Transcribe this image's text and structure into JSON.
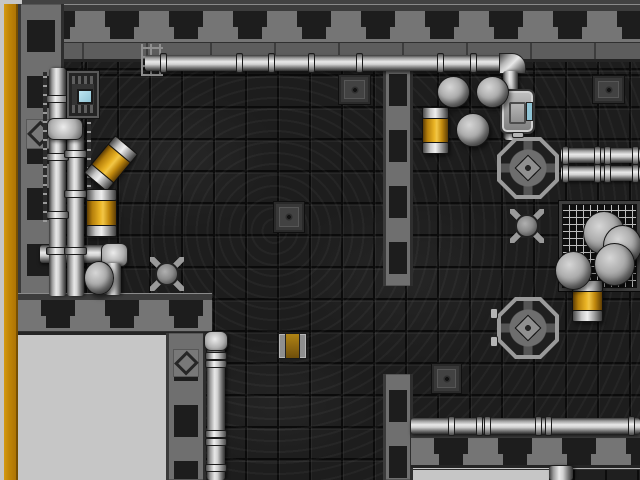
{
  "scene": {
    "width": 640,
    "height": 480,
    "palette": {
      "void": "#c6c6c6",
      "gold": "#bf8406",
      "wall_light": "#757575",
      "wall_dark": "#1d1d1d",
      "floor": "#1d1d1d",
      "pipe": "#d2d2d2",
      "barrel_orange": "#eab425",
      "screen_blue": "#8fc3d4",
      "spike_red": "#cf2418"
    },
    "objects": [
      {
        "name": "top-border-strip",
        "type": "top-strip",
        "x": 22,
        "y": 0,
        "w": 618,
        "h": 6,
        "interactable": false
      },
      {
        "name": "gold-border",
        "type": "gold-stripe",
        "x": 4,
        "y": 4,
        "w": 14,
        "h": 476,
        "interactable": false
      },
      {
        "name": "floor-main",
        "type": "floor",
        "x": 60,
        "y": 58,
        "w": 580,
        "h": 422,
        "interactable": false
      },
      {
        "name": "void-bottom-left",
        "type": "void",
        "x": 18,
        "y": 333,
        "w": 150,
        "h": 147,
        "interactable": false
      },
      {
        "name": "void-bottom-right",
        "type": "void",
        "x": 413,
        "y": 466,
        "w": 136,
        "h": 14,
        "interactable": false
      },
      {
        "name": "ledge-bottom-right",
        "type": "ledge",
        "x": 573,
        "y": 466,
        "w": 67,
        "h": 14,
        "interactable": false
      },
      {
        "name": "wall-top",
        "type": "wall-h",
        "x": 18,
        "y": 4,
        "w": 622,
        "h": 58,
        "interactable": false
      },
      {
        "name": "wall-left",
        "type": "wall-v",
        "x": 18,
        "y": 4,
        "w": 46,
        "h": 298,
        "interactable": false
      },
      {
        "name": "wall-room-a-bottom",
        "type": "wall-h",
        "x": 18,
        "y": 293,
        "w": 194,
        "h": 42,
        "interactable": false
      },
      {
        "name": "wall-void-column",
        "type": "wall-v",
        "x": 166,
        "y": 333,
        "w": 40,
        "h": 147,
        "interactable": false
      },
      {
        "name": "wall-divider-upper",
        "type": "wall-v",
        "x": 383,
        "y": 58,
        "w": 30,
        "h": 228,
        "interactable": false
      },
      {
        "name": "wall-divider-lower",
        "type": "wall-v",
        "x": 383,
        "y": 374,
        "w": 30,
        "h": 106,
        "interactable": false
      },
      {
        "name": "wall-room-b-bottom",
        "type": "wall-h",
        "x": 411,
        "y": 431,
        "w": 229,
        "h": 37,
        "interactable": false
      },
      {
        "name": "diamond-ornament",
        "type": "diamond",
        "x": 26,
        "y": 119,
        "w": 28,
        "h": 30,
        "interactable": false
      },
      {
        "name": "diamond-ornament",
        "type": "diamond",
        "x": 173,
        "y": 349,
        "w": 26,
        "h": 28,
        "interactable": false
      },
      {
        "name": "mesh-floor",
        "type": "mesh",
        "x": 559,
        "y": 201,
        "w": 81,
        "h": 90,
        "interactable": false
      },
      {
        "name": "pipe-junction",
        "type": "pipe-h",
        "x": 40,
        "y": 245,
        "w": 70,
        "h": 18,
        "interactable": false
      },
      {
        "name": "pipe-elbow-junction",
        "type": "pipe-joint",
        "x": 101,
        "y": 243,
        "w": 27,
        "h": 24,
        "interactable": false
      },
      {
        "name": "pipe-junction-drop",
        "type": "pipe-v",
        "x": 105,
        "y": 263,
        "w": 16,
        "h": 32,
        "interactable": false
      },
      {
        "name": "pipe-left-outer",
        "type": "pipe-v",
        "x": 49,
        "y": 68,
        "w": 17,
        "h": 228,
        "interactable": false
      },
      {
        "name": "pipe-left-inner",
        "type": "pipe-v",
        "x": 67,
        "y": 126,
        "w": 17,
        "h": 170,
        "interactable": false
      },
      {
        "name": "pipe-elbow-left",
        "type": "pipe-joint",
        "x": 47,
        "y": 118,
        "w": 36,
        "h": 22,
        "interactable": false
      },
      {
        "name": "pipe-coupling",
        "type": "coupling-v",
        "x": 46,
        "y": 95,
        "w": 23,
        "h": 8,
        "interactable": false
      },
      {
        "name": "pipe-coupling",
        "type": "coupling-v",
        "x": 46,
        "y": 153,
        "w": 23,
        "h": 8,
        "interactable": false
      },
      {
        "name": "pipe-coupling",
        "type": "coupling-v",
        "x": 46,
        "y": 211,
        "w": 23,
        "h": 8,
        "interactable": false
      },
      {
        "name": "pipe-coupling",
        "type": "coupling-v",
        "x": 46,
        "y": 247,
        "w": 23,
        "h": 8,
        "interactable": false
      },
      {
        "name": "pipe-coupling",
        "type": "coupling-v",
        "x": 64,
        "y": 150,
        "w": 23,
        "h": 8,
        "interactable": false
      },
      {
        "name": "pipe-coupling",
        "type": "coupling-v",
        "x": 64,
        "y": 190,
        "w": 23,
        "h": 8,
        "interactable": false
      },
      {
        "name": "pipe-coupling",
        "type": "coupling-v",
        "x": 64,
        "y": 247,
        "w": 23,
        "h": 8,
        "interactable": false
      },
      {
        "name": "wall-rail",
        "type": "rail-v",
        "x": 43,
        "y": 72,
        "w": 4,
        "h": 150,
        "interactable": false
      },
      {
        "name": "wall-rail",
        "type": "rail-v",
        "x": 87,
        "y": 122,
        "w": 4,
        "h": 110,
        "interactable": false
      },
      {
        "name": "pipe-bracket",
        "type": "pipe-bracket",
        "x": 141,
        "y": 44,
        "w": 22,
        "h": 32,
        "interactable": false
      },
      {
        "name": "pipe-top",
        "type": "pipe-h",
        "x": 145,
        "y": 55,
        "w": 358,
        "h": 16,
        "interactable": false
      },
      {
        "name": "pipe-coupling",
        "type": "coupling-h",
        "x": 160,
        "y": 53,
        "w": 7,
        "h": 20,
        "interactable": false
      },
      {
        "name": "pipe-coupling",
        "type": "coupling-h",
        "x": 236,
        "y": 53,
        "w": 7,
        "h": 20,
        "interactable": false
      },
      {
        "name": "pipe-coupling",
        "type": "coupling-h",
        "x": 268,
        "y": 53,
        "w": 7,
        "h": 20,
        "interactable": false
      },
      {
        "name": "pipe-coupling",
        "type": "coupling-h",
        "x": 308,
        "y": 53,
        "w": 7,
        "h": 20,
        "interactable": false
      },
      {
        "name": "pipe-coupling",
        "type": "coupling-h",
        "x": 356,
        "y": 53,
        "w": 7,
        "h": 20,
        "interactable": false
      },
      {
        "name": "pipe-coupling",
        "type": "coupling-h",
        "x": 437,
        "y": 53,
        "w": 7,
        "h": 20,
        "interactable": false
      },
      {
        "name": "pipe-coupling",
        "type": "coupling-h",
        "x": 470,
        "y": 53,
        "w": 7,
        "h": 20,
        "interactable": false
      },
      {
        "name": "pipe-elbow-top",
        "type": "pipe-elbow",
        "x": 499,
        "y": 53,
        "w": 27,
        "h": 21,
        "interactable": false
      },
      {
        "name": "pipe-top-drop",
        "type": "pipe-v",
        "x": 503,
        "y": 71,
        "w": 15,
        "h": 20,
        "interactable": false
      },
      {
        "name": "pipe-corridor",
        "type": "pipe-v",
        "x": 207,
        "y": 336,
        "w": 18,
        "h": 144,
        "interactable": false
      },
      {
        "name": "pipe-corridor-cap",
        "type": "pipe-joint",
        "x": 204,
        "y": 331,
        "w": 24,
        "h": 20,
        "interactable": false
      },
      {
        "name": "pipe-coupling",
        "type": "coupling-v",
        "x": 205,
        "y": 352,
        "w": 22,
        "h": 8,
        "interactable": false
      },
      {
        "name": "pipe-coupling",
        "type": "coupling-v",
        "x": 205,
        "y": 360,
        "w": 22,
        "h": 8,
        "interactable": false
      },
      {
        "name": "pipe-coupling",
        "type": "coupling-v",
        "x": 205,
        "y": 430,
        "w": 22,
        "h": 8,
        "interactable": false
      },
      {
        "name": "pipe-coupling",
        "type": "coupling-v",
        "x": 205,
        "y": 438,
        "w": 22,
        "h": 8,
        "interactable": false
      },
      {
        "name": "pipe-coupling",
        "type": "coupling-v",
        "x": 205,
        "y": 464,
        "w": 22,
        "h": 8,
        "interactable": false
      },
      {
        "name": "pipe-right-upper",
        "type": "pipe-h",
        "x": 561,
        "y": 148,
        "w": 79,
        "h": 15,
        "interactable": false
      },
      {
        "name": "pipe-right-lower",
        "type": "pipe-h",
        "x": 561,
        "y": 166,
        "w": 79,
        "h": 15,
        "interactable": false
      },
      {
        "name": "pipe-coupling",
        "type": "coupling-h",
        "x": 562,
        "y": 146,
        "w": 7,
        "h": 19,
        "interactable": false
      },
      {
        "name": "pipe-coupling",
        "type": "coupling-h",
        "x": 594,
        "y": 146,
        "w": 7,
        "h": 19,
        "interactable": false
      },
      {
        "name": "pipe-coupling",
        "type": "coupling-h",
        "x": 604,
        "y": 146,
        "w": 7,
        "h": 19,
        "interactable": false
      },
      {
        "name": "pipe-coupling",
        "type": "coupling-h",
        "x": 632,
        "y": 146,
        "w": 7,
        "h": 19,
        "interactable": false
      },
      {
        "name": "pipe-coupling",
        "type": "coupling-h",
        "x": 562,
        "y": 164,
        "w": 7,
        "h": 19,
        "interactable": false
      },
      {
        "name": "pipe-coupling",
        "type": "coupling-h",
        "x": 594,
        "y": 164,
        "w": 7,
        "h": 19,
        "interactable": false
      },
      {
        "name": "pipe-coupling",
        "type": "coupling-h",
        "x": 604,
        "y": 164,
        "w": 7,
        "h": 19,
        "interactable": false
      },
      {
        "name": "pipe-coupling",
        "type": "coupling-h",
        "x": 632,
        "y": 164,
        "w": 7,
        "h": 19,
        "interactable": false
      },
      {
        "name": "pipe-bottom",
        "type": "pipe-h",
        "x": 411,
        "y": 418,
        "w": 229,
        "h": 16,
        "interactable": false
      },
      {
        "name": "pipe-coupling",
        "type": "coupling-h",
        "x": 448,
        "y": 416,
        "w": 7,
        "h": 20,
        "interactable": false
      },
      {
        "name": "pipe-coupling",
        "type": "coupling-h",
        "x": 476,
        "y": 416,
        "w": 7,
        "h": 20,
        "interactable": false
      },
      {
        "name": "pipe-coupling",
        "type": "coupling-h",
        "x": 484,
        "y": 416,
        "w": 7,
        "h": 20,
        "interactable": false
      },
      {
        "name": "pipe-coupling",
        "type": "coupling-h",
        "x": 535,
        "y": 416,
        "w": 7,
        "h": 20,
        "interactable": false
      },
      {
        "name": "pipe-coupling",
        "type": "coupling-h",
        "x": 545,
        "y": 416,
        "w": 7,
        "h": 20,
        "interactable": false
      },
      {
        "name": "pipe-coupling",
        "type": "coupling-h",
        "x": 628,
        "y": 416,
        "w": 7,
        "h": 20,
        "interactable": false
      },
      {
        "name": "generator-stub",
        "type": "pipe-v",
        "x": 504,
        "y": 130,
        "w": 14,
        "h": 10,
        "interactable": false
      },
      {
        "name": "pipe-stub-bottom",
        "type": "pipe-v",
        "x": 549,
        "y": 466,
        "w": 24,
        "h": 14,
        "interactable": false
      },
      {
        "name": "console",
        "type": "console",
        "x": 67,
        "y": 71,
        "w": 32,
        "h": 47,
        "interactable": true
      },
      {
        "name": "generator",
        "type": "generator",
        "x": 500,
        "y": 89,
        "w": 35,
        "h": 45,
        "interactable": true
      },
      {
        "name": "teleport-pad",
        "type": "pad",
        "x": 497,
        "y": 137,
        "w": 62,
        "h": 62,
        "interactable": true
      },
      {
        "name": "pad-tab",
        "type": "pad-tab",
        "x": 512,
        "y": 132,
        "w": 12,
        "h": 6,
        "interactable": false
      },
      {
        "name": "teleport-pad",
        "type": "pad",
        "x": 497,
        "y": 297,
        "w": 62,
        "h": 62,
        "interactable": true
      },
      {
        "name": "pad-tab",
        "type": "pad-tab",
        "x": 490,
        "y": 308,
        "w": 8,
        "h": 11,
        "interactable": false
      },
      {
        "name": "pad-tab",
        "type": "pad-tab",
        "x": 490,
        "y": 336,
        "w": 8,
        "h": 11,
        "interactable": false
      },
      {
        "name": "crate",
        "type": "crate",
        "x": 339,
        "y": 75,
        "w": 31,
        "h": 29,
        "interactable": true
      },
      {
        "name": "crate",
        "type": "crate",
        "x": 593,
        "y": 76,
        "w": 31,
        "h": 27,
        "interactable": true
      },
      {
        "name": "crate",
        "type": "crate",
        "x": 274,
        "y": 202,
        "w": 30,
        "h": 30,
        "interactable": true
      },
      {
        "name": "crate",
        "type": "crate",
        "x": 432,
        "y": 364,
        "w": 29,
        "h": 29,
        "interactable": true
      },
      {
        "name": "crate-amber",
        "type": "crate-amber",
        "x": 278,
        "y": 333,
        "w": 29,
        "h": 26,
        "interactable": true
      },
      {
        "name": "barrel-orange",
        "type": "barrel",
        "x": 96,
        "y": 139,
        "w": 30,
        "h": 49,
        "rot": 40,
        "interactable": true
      },
      {
        "name": "barrel-orange",
        "type": "barrel",
        "x": 86,
        "y": 189,
        "w": 31,
        "h": 48,
        "interactable": true
      },
      {
        "name": "barrel-orange",
        "type": "barrel",
        "x": 422,
        "y": 107,
        "w": 27,
        "h": 47,
        "interactable": true
      },
      {
        "name": "barrel-orange",
        "type": "barrel",
        "x": 572,
        "y": 280,
        "w": 31,
        "h": 42,
        "interactable": true
      },
      {
        "name": "boulder",
        "type": "boulder",
        "x": 437,
        "y": 76,
        "w": 33,
        "h": 32,
        "interactable": true
      },
      {
        "name": "boulder",
        "type": "boulder",
        "x": 476,
        "y": 76,
        "w": 33,
        "h": 32,
        "interactable": true
      },
      {
        "name": "boulder",
        "type": "boulder",
        "x": 456,
        "y": 113,
        "w": 34,
        "h": 34,
        "interactable": true
      },
      {
        "name": "boulder",
        "type": "boulder",
        "x": 84,
        "y": 261,
        "w": 30,
        "h": 34,
        "interactable": true
      },
      {
        "name": "boulder",
        "type": "boulder",
        "x": 583,
        "y": 211,
        "w": 42,
        "h": 44,
        "interactable": true
      },
      {
        "name": "boulder",
        "type": "boulder",
        "x": 603,
        "y": 225,
        "w": 39,
        "h": 41,
        "interactable": true
      },
      {
        "name": "boulder",
        "type": "boulder",
        "x": 594,
        "y": 243,
        "w": 41,
        "h": 43,
        "interactable": true
      },
      {
        "name": "boulder",
        "type": "boulder",
        "x": 555,
        "y": 251,
        "w": 37,
        "h": 39,
        "interactable": true
      },
      {
        "name": "turret-mine",
        "type": "turret",
        "x": 150,
        "y": 257,
        "w": 34,
        "h": 34,
        "interactable": true
      },
      {
        "name": "turret-mine",
        "type": "turret",
        "x": 510,
        "y": 209,
        "w": 34,
        "h": 34,
        "interactable": true
      }
    ]
  }
}
